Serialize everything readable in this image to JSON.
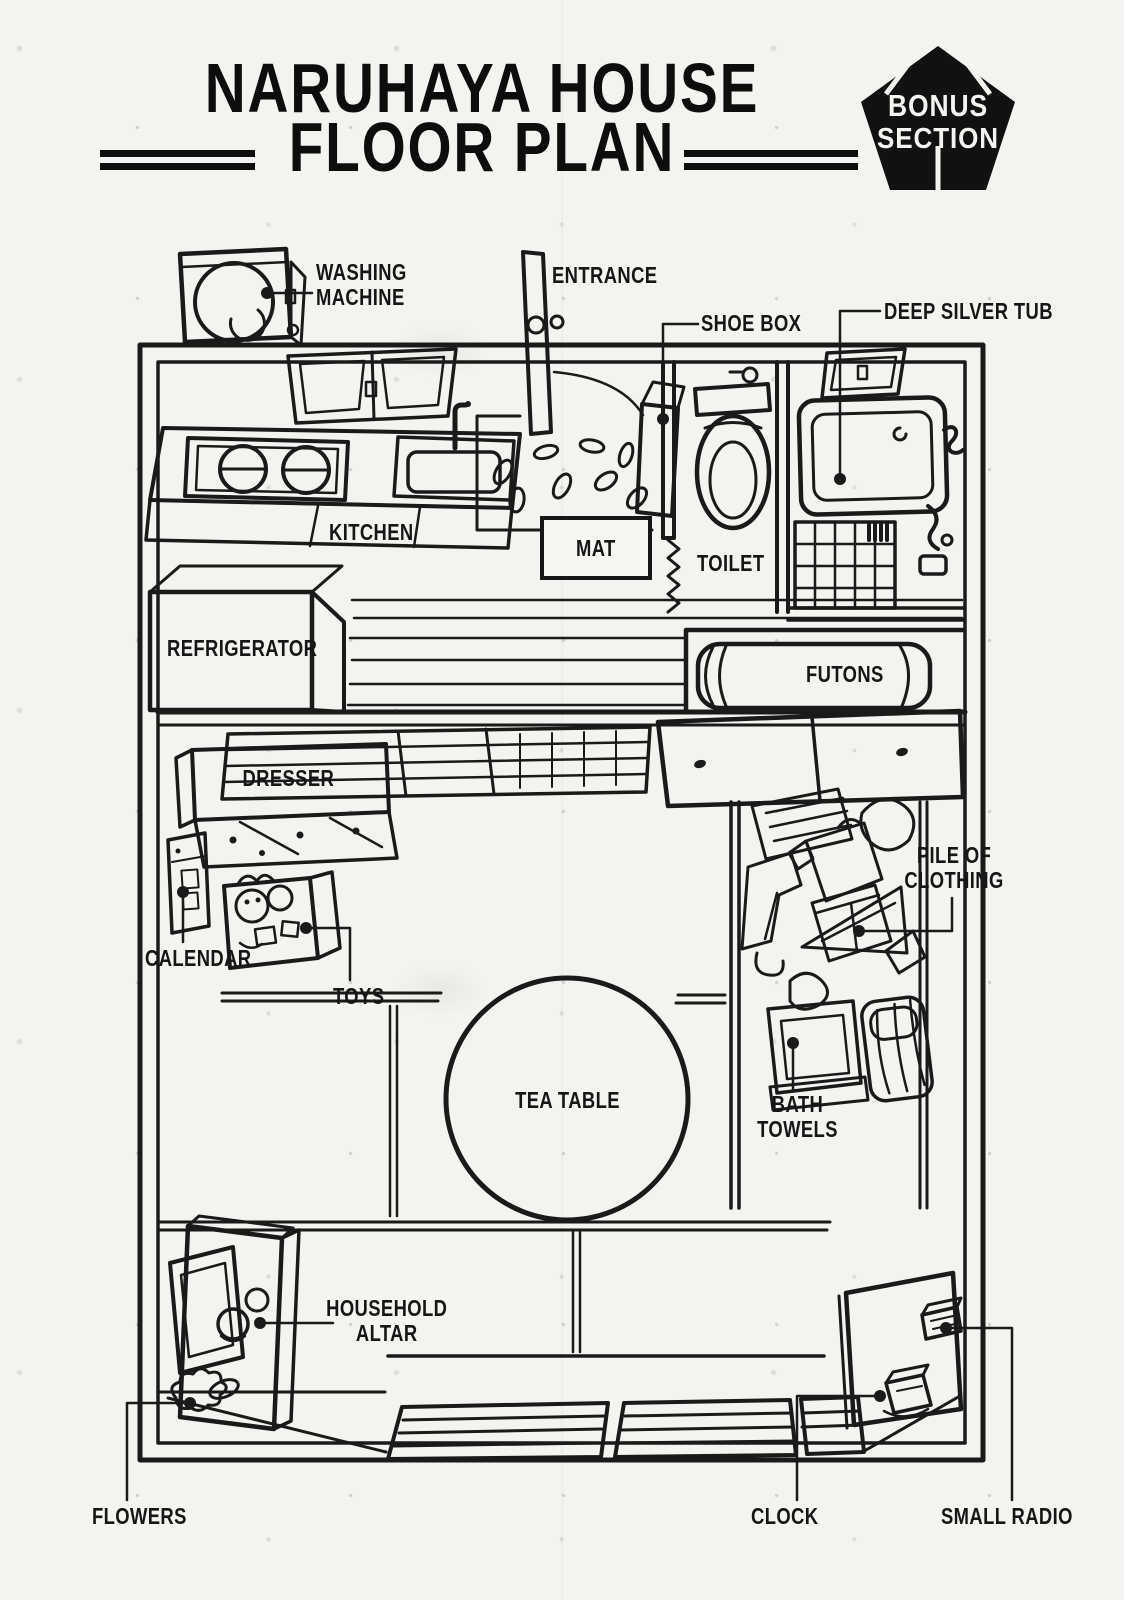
{
  "colors": {
    "ink": "#1a1a1a",
    "paper": "#f4f3f0"
  },
  "header": {
    "title_line1": "NARUHAYA HOUSE",
    "title_line2": "FLOOR PLAN",
    "badge_line1": "BONUS",
    "badge_line2": "SECTION"
  },
  "labels": {
    "washing_machine": "WASHING\nMACHINE",
    "entrance": "ENTRANCE",
    "shoe_box": "SHOE BOX",
    "deep_silver_tub": "DEEP SILVER TUB",
    "kitchen": "KITCHEN",
    "mat": "MAT",
    "toilet": "TOILET",
    "refrigerator": "REFRIGERATOR",
    "futons": "FUTONS",
    "dresser": "DRESSER",
    "calendar": "CALENDAR",
    "toys": "TOYS",
    "tea_table": "TEA TABLE",
    "pile_of_clothing": "PILE OF\nCLOTHING",
    "bath_towels": "BATH\nTOWELS",
    "household_altar": "HOUSEHOLD\nALTAR",
    "flowers": "FLOWERS",
    "clock": "CLOCK",
    "small_radio": "SMALL RADIO"
  }
}
